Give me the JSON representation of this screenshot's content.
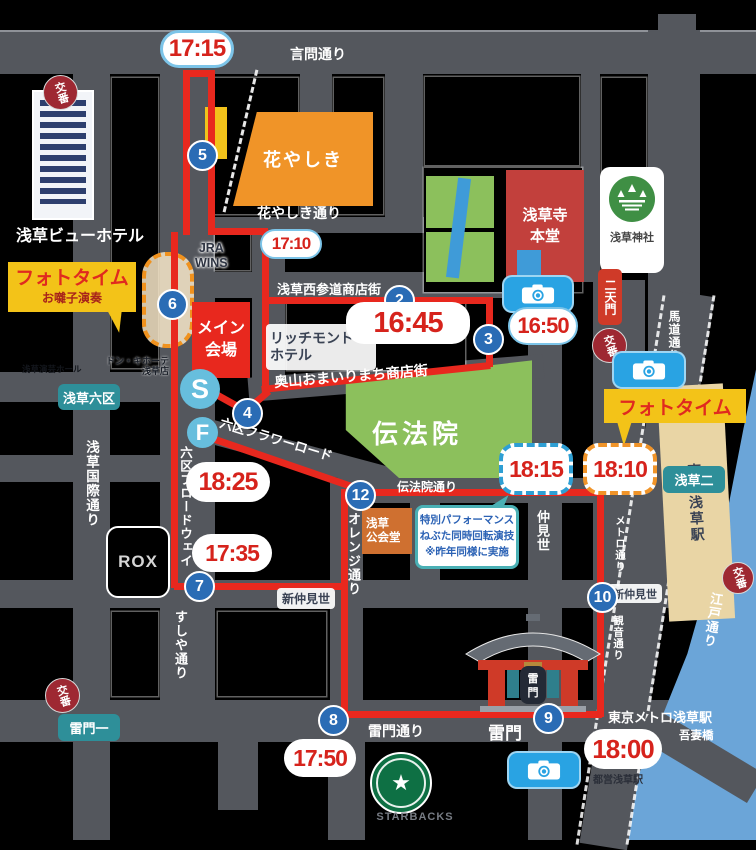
{
  "map": {
    "streets": {
      "kototoi": "言問通り",
      "hanayashiki_st": "花やしき通り",
      "nishisando": "浅草西参道商店街",
      "okuyama": "奥山おまいりまち商店街",
      "flower": "六区フラワーロード",
      "denboin_st": "伝法院通り",
      "shinnaka_w": "新仲見世",
      "shinnaka_e": "新仲見世",
      "kaminari_st": "雷門通り",
      "kokusai": "浅草国際通り",
      "broadway": "六区ブロードウェイ",
      "sushiya": "すしや通り",
      "orange": "オレンジ通り",
      "nakamise": "仲見世",
      "metro": "メトロ通り",
      "kannon": "観音通り",
      "umamichi": "馬道通り",
      "edo": "江戸通り"
    },
    "places": {
      "view_hotel": "浅草ビューホテル",
      "hanayashiki": "花やしき",
      "sensoji_l1": "浅草寺",
      "sensoji_l2": "本堂",
      "jinja": "浅草神社",
      "nitenmon": "二天門",
      "gojunoto": "五重塔",
      "denboin": "伝法院",
      "main_l1": "メイン",
      "main_l2": "会場",
      "jra": "JRA",
      "wins": "WINS",
      "richmond_l1": "リッチモンド",
      "richmond_l2": "ホテル",
      "engei": "浅草演芸ホール",
      "donki_l1": "ドン・キホーテ",
      "donki_l2": "浅草店",
      "kokaido_l1": "浅草",
      "kokaido_l2": "公会堂",
      "rox": "ROX",
      "tobu": "東武浅草駅",
      "metro_station": "東京メトロ浅草駅",
      "toei": "都営浅草駅",
      "azumabashi": "吾妻橋",
      "kaminarimon": "雷門",
      "starbucks": "STARBACKS",
      "koban": "交番"
    },
    "towns": {
      "rokku": "浅草六区",
      "kaminari1": "雷門一",
      "asakusa2": "浅草二"
    },
    "stops": {
      "n2": "2",
      "n3": "3",
      "n4": "4",
      "n5": "5",
      "n6": "6",
      "n7": "7",
      "n8": "8",
      "n9": "9",
      "n10": "10",
      "n12": "12",
      "s": "S",
      "f": "F"
    },
    "times": {
      "t1715": "17:15",
      "t1710": "17:10",
      "t1645": "16:45",
      "t1650": "16:50",
      "t1735": "17:35",
      "t1750": "17:50",
      "t1800": "18:00",
      "t1810": "18:10",
      "t1815": "18:15",
      "t1825": "18:25"
    },
    "phototime": {
      "left_title": "フォトタイム",
      "left_sub": "お囃子演奏",
      "right_title": "フォトタイム"
    },
    "note": {
      "line1": "特別パフォーマンス",
      "line2": "ねぶた同時回転演技",
      "line3": "※昨年同様に実施"
    },
    "colors": {
      "route": "#e8281e",
      "street": "#54575d",
      "time_text": "#d6231c",
      "stop_circle": "#2a6cb5",
      "start_finish": "#67bedd",
      "phototime_bg": "#f3c318",
      "park_green": "#8cc05c",
      "temple_red": "#c2403c",
      "river_blue": "#6ba5d8"
    }
  }
}
